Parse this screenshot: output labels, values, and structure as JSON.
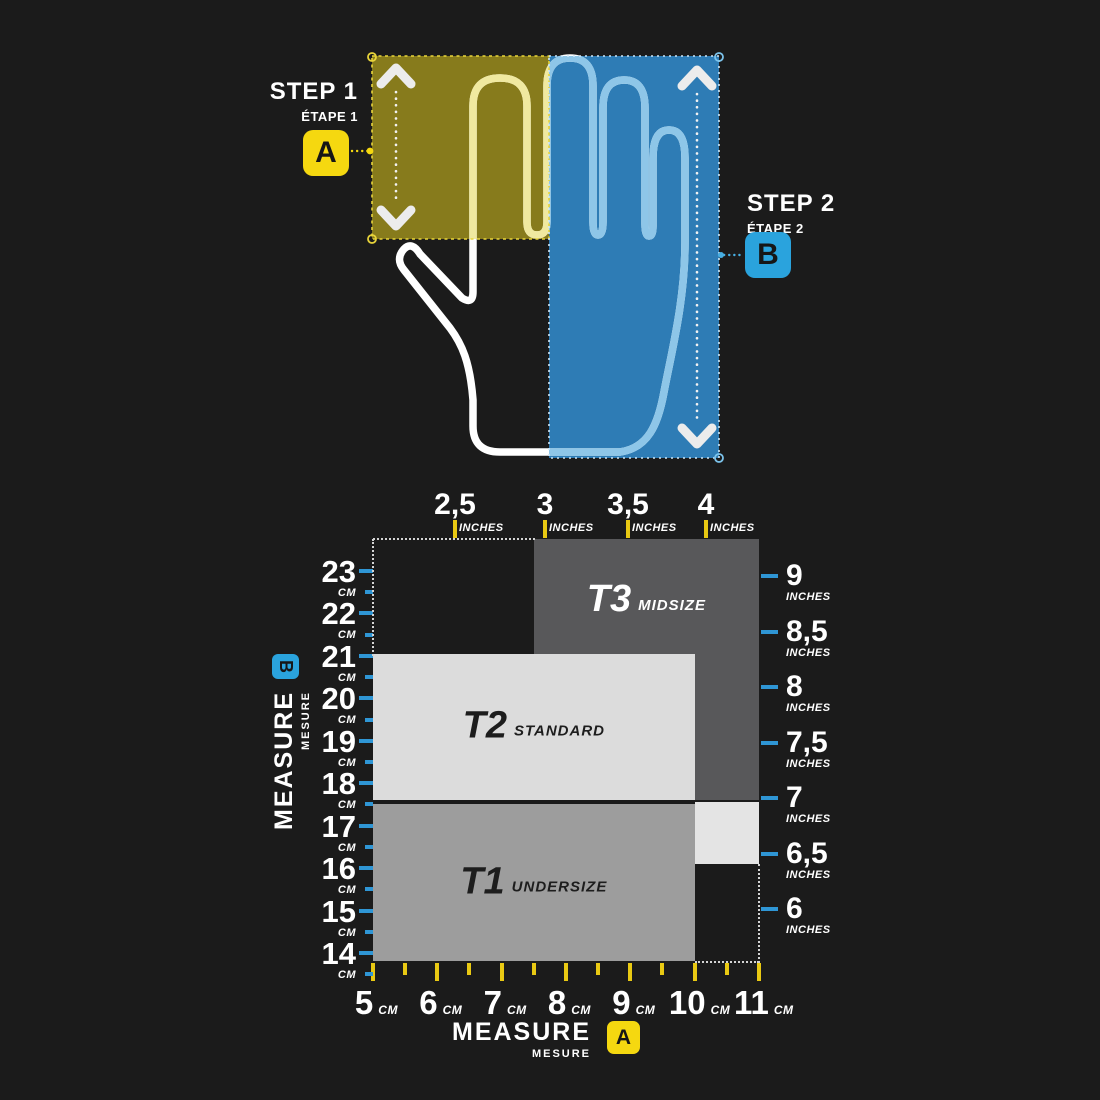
{
  "colors": {
    "background": "#1b1b1b",
    "yellow": "#f5d810",
    "blue": "#2aa3dd",
    "width_axis_tick": "#e9c913",
    "length_axis_tick": "#2f96d5",
    "hand_outline": "#ffffff",
    "hand_width_zone": "#877b1c",
    "hand_length_zone": "#2e7cb5",
    "hand_finger_yellow": "#f0e9a0",
    "hand_finger_blue": "#8ec6e8"
  },
  "steps": {
    "step1": {
      "title": "STEP 1",
      "subtitle": "ÉTAPE 1",
      "badge": "A"
    },
    "step2": {
      "title": "STEP 2",
      "subtitle": "ÉTAPE 2",
      "badge": "B"
    }
  },
  "measure_left": {
    "label": "MEASURE",
    "sublabel": "MESURE",
    "badge": "B"
  },
  "measure_bottom": {
    "label": "MEASURE",
    "sublabel": "MESURE",
    "badge": "A"
  },
  "chart_data": {
    "type": "area",
    "title": "Glove size chart: hand width (A) vs hand length (B)",
    "axes": {
      "top": {
        "unit_label": "INCHES",
        "values": [
          2.5,
          3,
          3.5,
          4
        ],
        "display": [
          "2,5",
          "3",
          "3,5",
          "4"
        ]
      },
      "bottom": {
        "unit_label": "CM",
        "values": [
          5,
          6,
          7,
          8,
          9,
          10,
          11
        ],
        "display": [
          "5",
          "6",
          "7",
          "8",
          "9",
          "10",
          "11"
        ]
      },
      "left": {
        "unit_label": "CM",
        "values": [
          23,
          22,
          21,
          20,
          19,
          18,
          17,
          16,
          15,
          14
        ],
        "display": [
          "23",
          "22",
          "21",
          "20",
          "19",
          "18",
          "17",
          "16",
          "15",
          "14"
        ]
      },
      "right": {
        "unit_label": "INCHES",
        "values": [
          9,
          8.5,
          8,
          7.5,
          7,
          6.5,
          6
        ],
        "display": [
          "9",
          "8,5",
          "8",
          "7,5",
          "7",
          "6,5",
          "6"
        ]
      }
    },
    "zones": [
      {
        "id": "T3",
        "name": "MIDSIZE",
        "width_cm": [
          7.5,
          11
        ],
        "length_cm": [
          17.6,
          23.75
        ],
        "color": "#58585a",
        "text_color": "#ffffff",
        "label_pos": "top"
      },
      {
        "id": "T2",
        "name": "STANDARD",
        "width_cm": [
          5,
          10
        ],
        "length_cm": [
          17.6,
          21.05
        ],
        "color": "#dcdcdc",
        "text_color": "#1d1d1d",
        "label_pos": "center"
      },
      {
        "id": "T1",
        "name": "UNDERSIZE",
        "width_cm": [
          5,
          10
        ],
        "length_cm": [
          13.8,
          17.5
        ],
        "color": "#9d9d9d",
        "text_color": "#1d1d1d",
        "label_pos": "center"
      },
      {
        "id": "",
        "name": "",
        "width_cm": [
          10,
          11
        ],
        "length_cm": [
          16.1,
          17.55
        ],
        "color": "#e4e4e4",
        "text_color": "#1d1d1d",
        "label_pos": "center"
      }
    ]
  }
}
